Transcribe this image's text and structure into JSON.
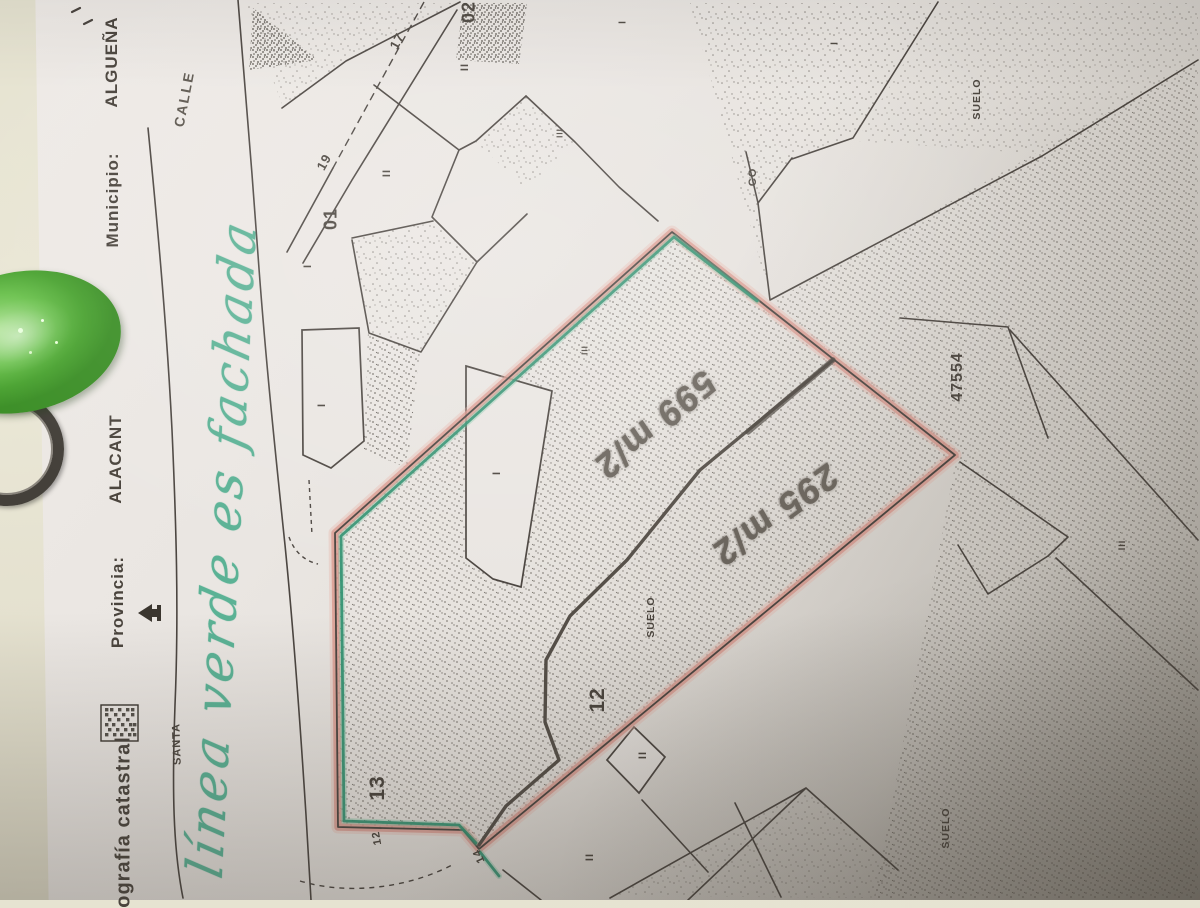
{
  "document": {
    "header": {
      "municipio_label": "Municipio:",
      "municipio_value": "ALGUEÑA",
      "provincia_label": "Provincia:",
      "provincia_value": "ALACANT",
      "footer_title": "ografía catastral"
    },
    "streets": {
      "calle": "CALLE",
      "santa": "SANTA"
    },
    "parcel_reference": "47554",
    "land_labels": {
      "suelo_1": "SUELO",
      "suelo_2": "SUELO",
      "suelo_3": "SUELO",
      "co": "CO"
    },
    "parcel_numbers": {
      "p01": "01",
      "p02": "02",
      "p12": "12",
      "p13": "13",
      "p17": "17",
      "p19": "19",
      "house_12": "12",
      "house_14": "14"
    },
    "roman_marks": {
      "r1": "II",
      "r2": "II",
      "r3": "I",
      "r4": "III",
      "r5": "I",
      "r6": "I",
      "r7": "I",
      "r8": "I",
      "r9": "III",
      "r10": "II",
      "r11": "II",
      "r12": "III"
    },
    "annotations": {
      "green_note": "línea verde es fachada",
      "area_1": "599 m/2",
      "area_2": "295 m/2"
    },
    "colors": {
      "facade_green": "#2f9170",
      "boundary_pink": "#d9968b",
      "pencil_gray": "#6b655d",
      "marker_green": "#4fae8f",
      "map_ink": "#4b4540",
      "paper": "#e9e5e1"
    }
  }
}
